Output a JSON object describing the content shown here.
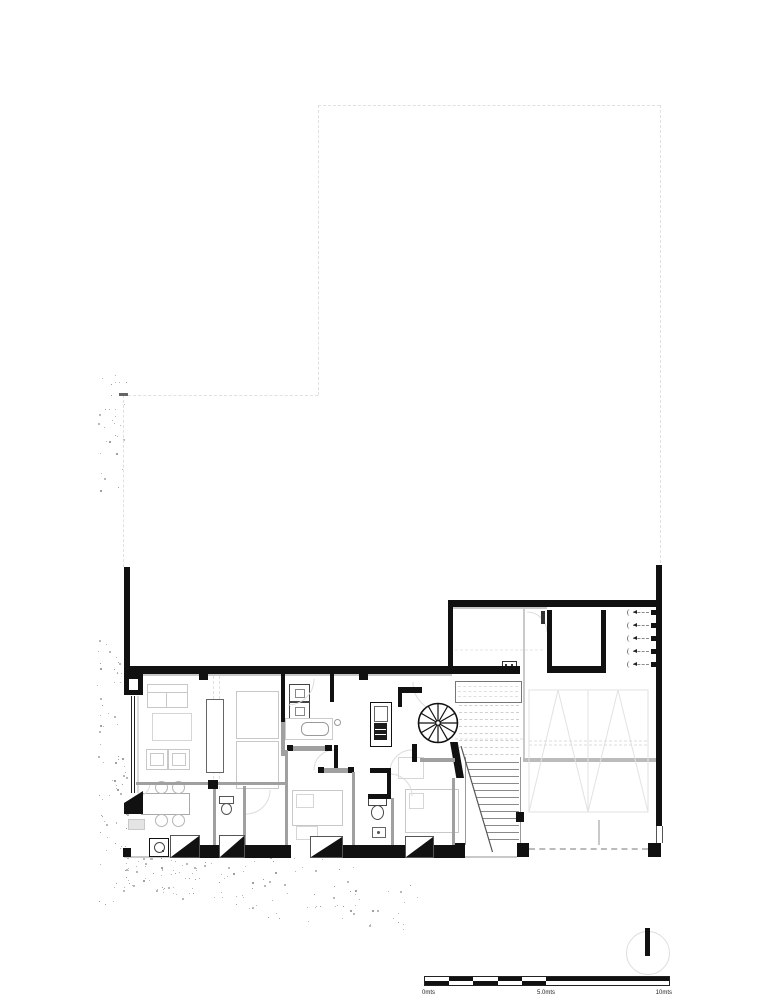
{
  "sheet": {
    "width": 777,
    "height": 1000,
    "background": "#ffffff"
  },
  "drawing": {
    "kind": "architectural ground floor plan",
    "features": {
      "utility_meters": 5,
      "straight_stair_treads": 12,
      "upper_flight_dashed_treads": 8,
      "landing_dashed_lines": 3,
      "spiral_stair_spokes": 12,
      "door_thresholds": 4,
      "garage_chevrons": 2
    }
  },
  "scale_bar": {
    "segments_left": 5,
    "start_label": "0mts",
    "mid_label": "5.0mts",
    "end_label": "10mts"
  },
  "north_indicator": {
    "style": "circle-with-bar"
  },
  "colors": {
    "wall": "#111111",
    "partition_gray": "#a0a0a0",
    "furniture_outline": "#c8c8c8",
    "boundary_dash": "#e0e0e0",
    "tread_gray": "#8a8a8a",
    "speckle": "#b8b8b8"
  }
}
